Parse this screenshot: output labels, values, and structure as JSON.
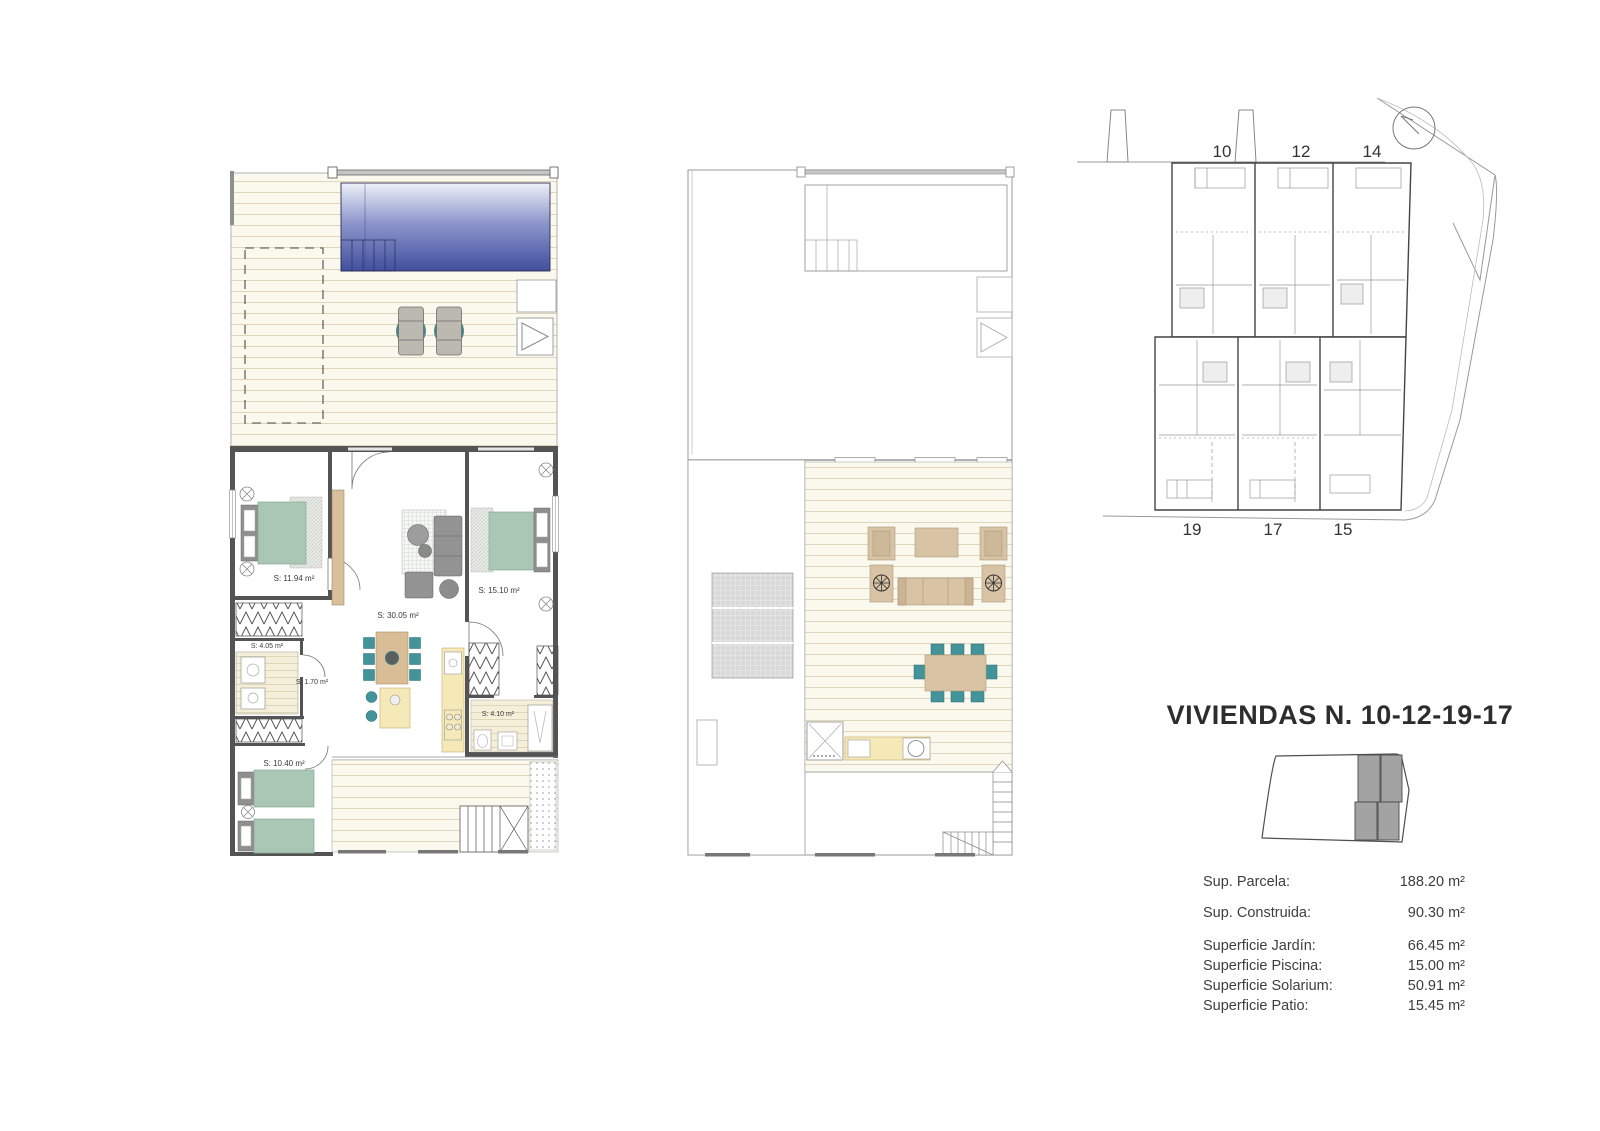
{
  "sheet": {
    "title": "VIVIENDAS N. 10-12-19-17"
  },
  "ground_floor": {
    "rooms": [
      {
        "label": "S: 11.94 m²"
      },
      {
        "label": "S: 4.05 m²"
      },
      {
        "label": "S: 1.70 m²"
      },
      {
        "label": "S: 30.05 m²"
      },
      {
        "label": "S: 15.10 m²"
      },
      {
        "label": "S: 4.10 m²"
      },
      {
        "label": "S: 10.40 m²"
      }
    ]
  },
  "site_plan": {
    "units_top": [
      "10",
      "12",
      "14"
    ],
    "units_bottom": [
      "19",
      "17",
      "15"
    ]
  },
  "areas": {
    "rows": [
      {
        "label": "Sup. Parcela:",
        "value": "188.20 m²"
      },
      {
        "label": "Sup. Construida:",
        "value": "90.30 m²"
      },
      {
        "label": "Superficie Jardín:",
        "value": "66.45 m²"
      },
      {
        "label": "Superficie Piscina:",
        "value": "15.00 m²"
      },
      {
        "label": "Superficie Solarium:",
        "value": "50.91 m²"
      },
      {
        "label": "Superficie Patio:",
        "value": "15.45 m²"
      }
    ]
  },
  "colors": {
    "pool_top": "#eef0f8",
    "pool_bottom": "#41509f",
    "deck_cream": "#fbf9ed",
    "bed_green": "#aac7b5",
    "accent_teal": "#43939b",
    "wood_tan": "#d8bd97",
    "kitchen_yellow": "#f6e9b8",
    "wall_gray": "#545454",
    "highlight_gray": "#a3a3a3"
  }
}
